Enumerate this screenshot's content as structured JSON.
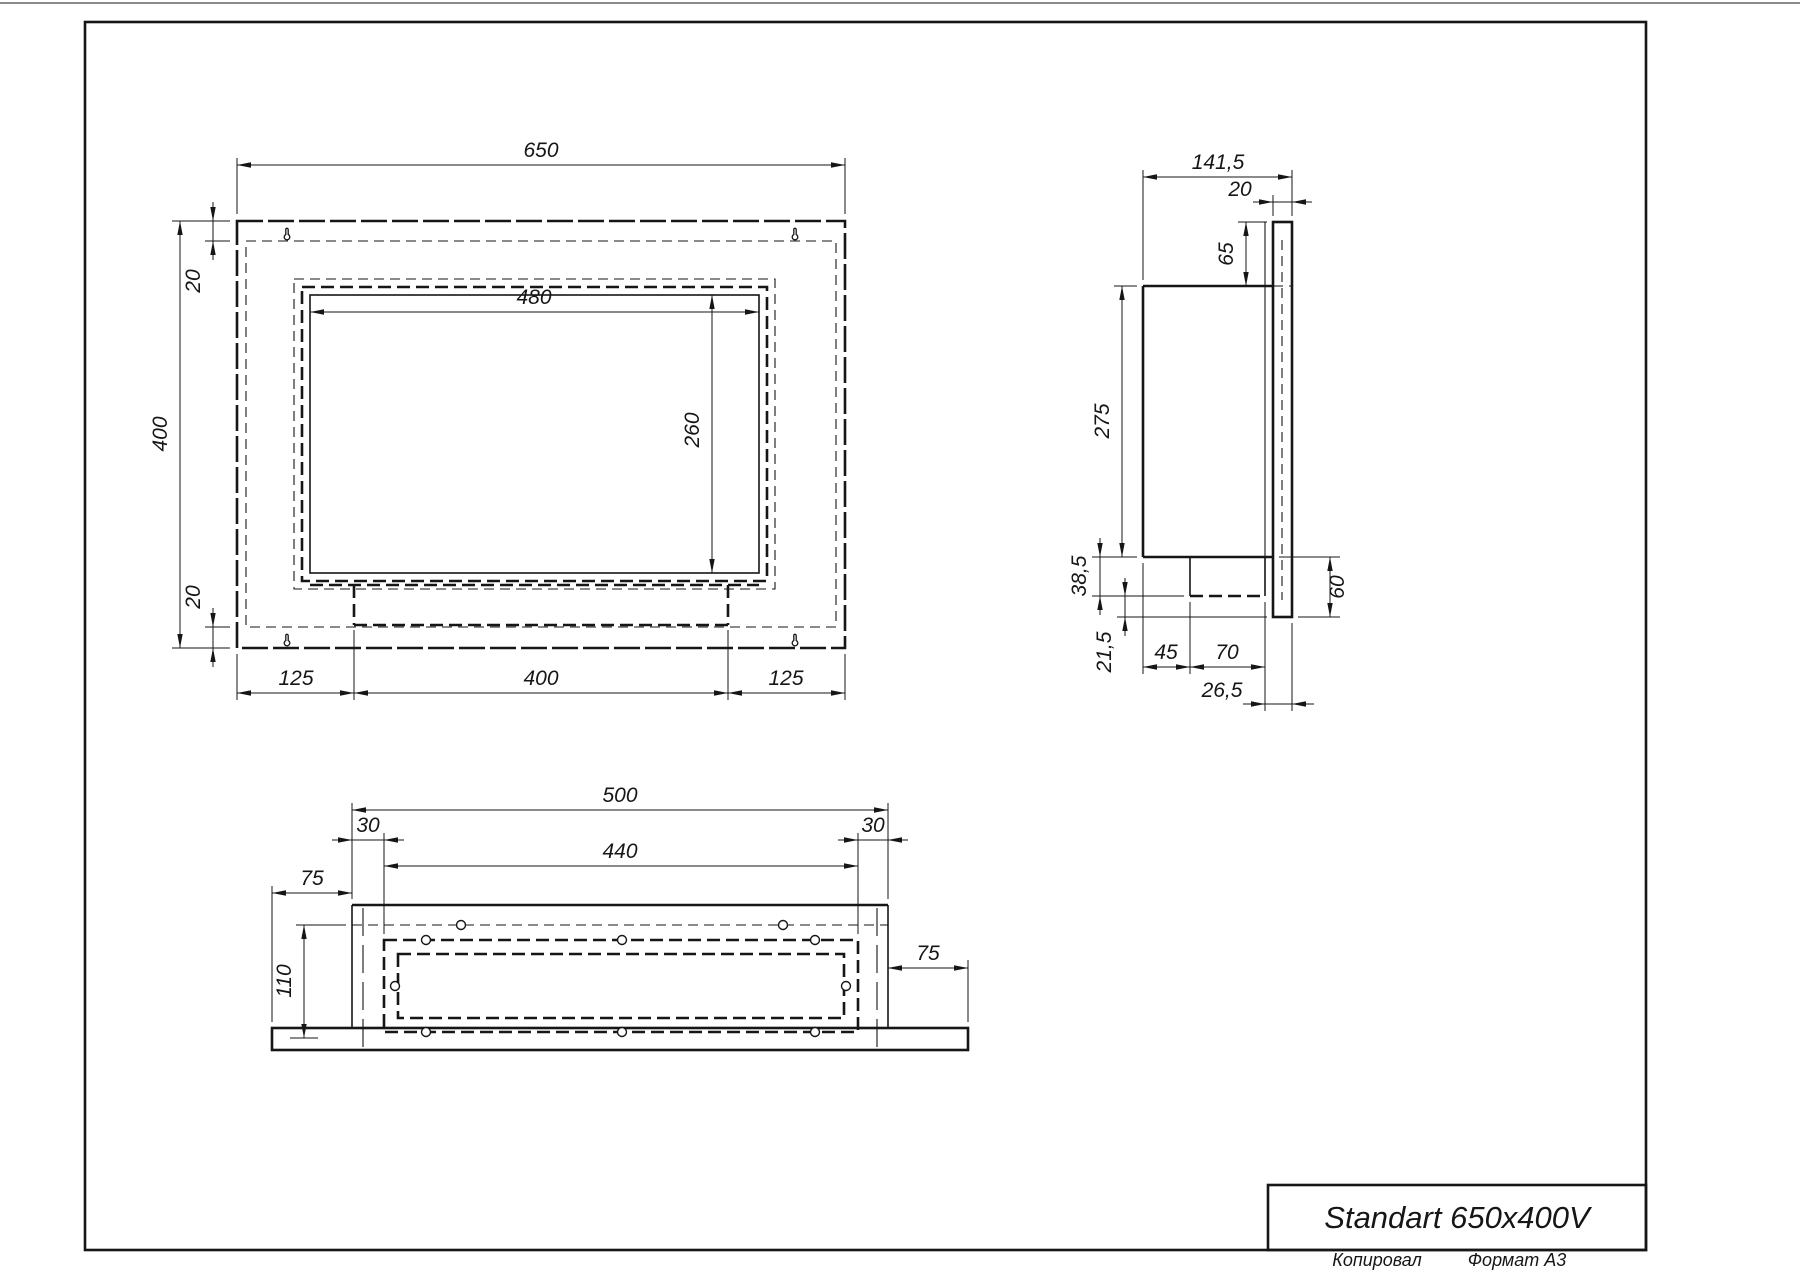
{
  "title_block": {
    "title": "Standart 650x400V"
  },
  "footer": {
    "copied": "Копировал",
    "format": "Формат А3"
  },
  "views": {
    "front": {
      "dims": {
        "overall_width": "650",
        "overall_height": "400",
        "top_offset": "20",
        "bottom_offset": "20",
        "opening_width": "480",
        "opening_height": "260",
        "bottom_left": "125",
        "bottom_center": "400",
        "bottom_right": "125"
      }
    },
    "side": {
      "dims": {
        "overall_depth": "141,5",
        "panel_thickness": "20",
        "panel_above_top": "65",
        "body_height": "275",
        "tray_depth": "38,5",
        "tray_to_panel_bottom": "21,5",
        "tray_offset": "45",
        "tray_width": "70",
        "tray_to_panel_edge": "26,5",
        "panel_below_body": "60"
      }
    },
    "bottom": {
      "dims": {
        "body_width": "500",
        "inset_left": "30",
        "burner_frame_width": "440",
        "inset_right": "30",
        "flange_left": "75",
        "flange_right": "75",
        "body_depth": "110"
      }
    }
  }
}
